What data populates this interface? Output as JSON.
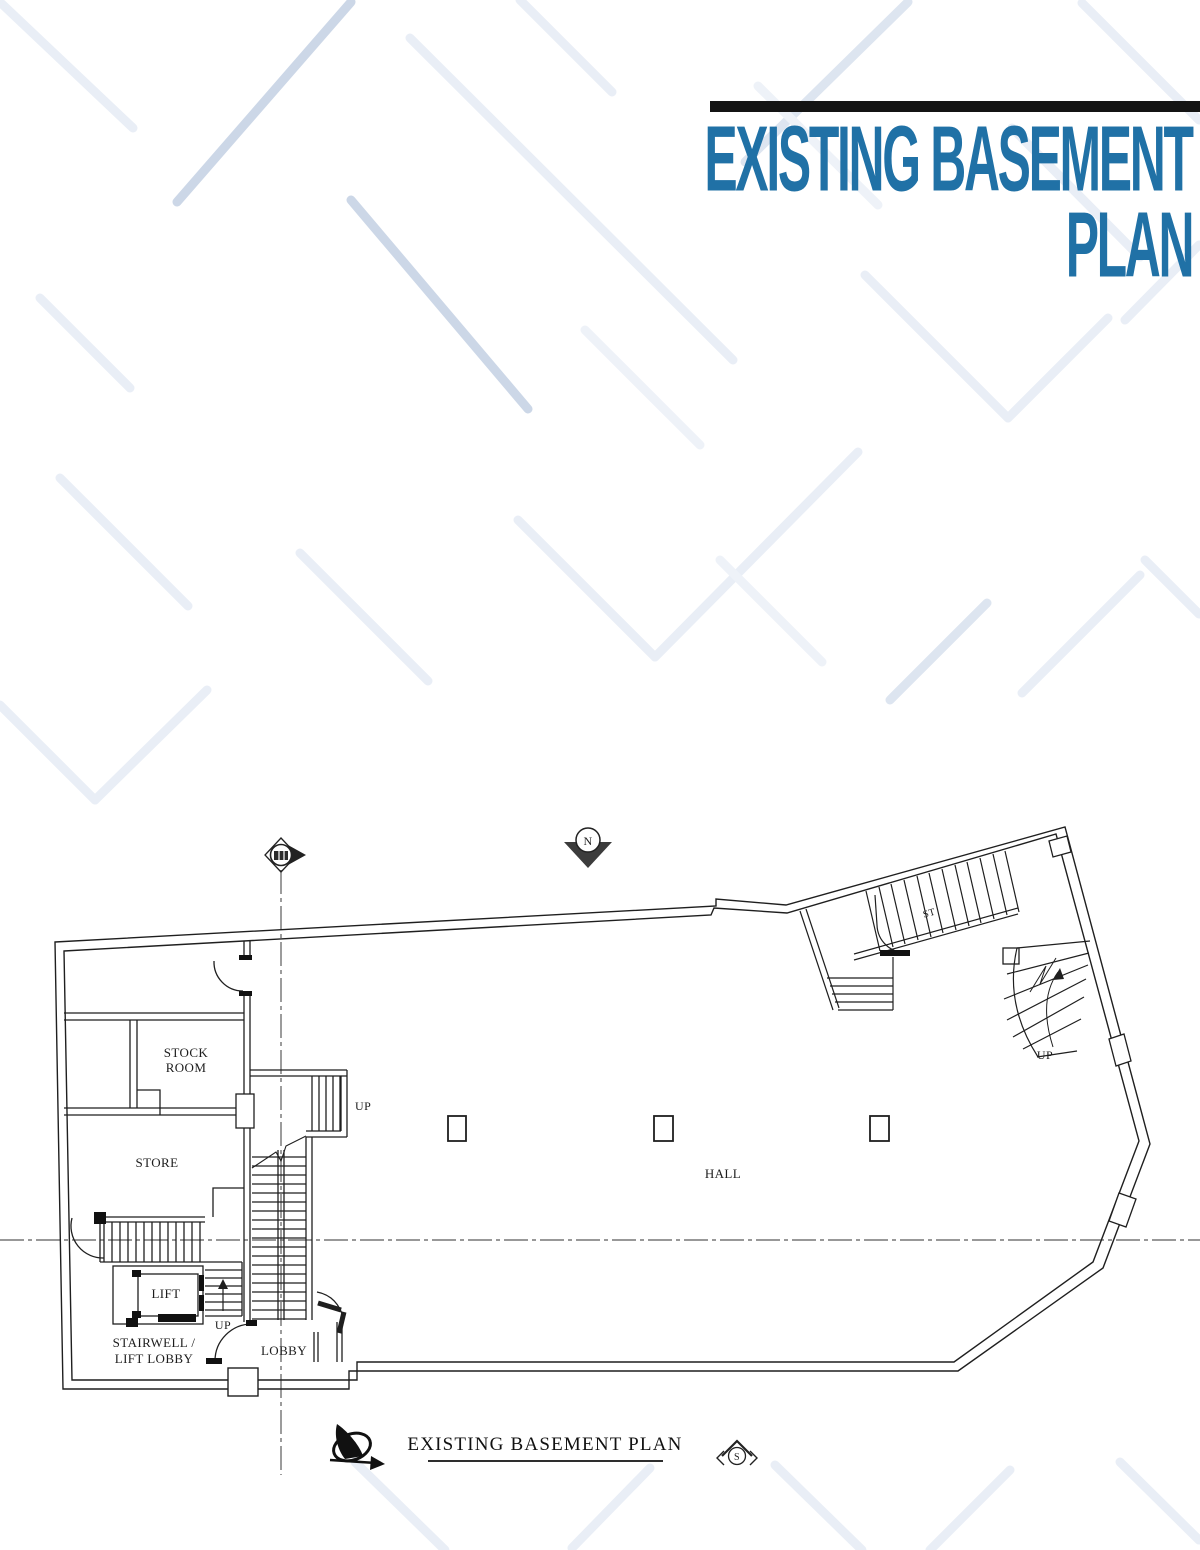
{
  "header": {
    "title_line1": "EXISTING BASEMENT",
    "title_line2": "PLAN",
    "title_color": "#2071a6",
    "bar_color": "#141414"
  },
  "pattern_colors": {
    "light": "#e9eef6",
    "mid": "#dde5f0",
    "dark": "#ccd7e7"
  },
  "plan": {
    "ink_color": "#1f1f1f",
    "caption": "EXISTING BASEMENT PLAN",
    "labels": {
      "stock_room_line1": "STOCK",
      "stock_room_line2": "ROOM",
      "store": "STORE",
      "lift": "LIFT",
      "hall": "HALL",
      "lobby": "LOBBY",
      "stairwell_line1": "STAIRWELL /",
      "stairwell_line2": "LIFT LOBBY",
      "up_center_stair": "UP",
      "up_lift_stair": "UP",
      "up_winder_stair": "UP",
      "stair_label": "ST",
      "north_letter": "N",
      "south_letter": "S"
    }
  }
}
